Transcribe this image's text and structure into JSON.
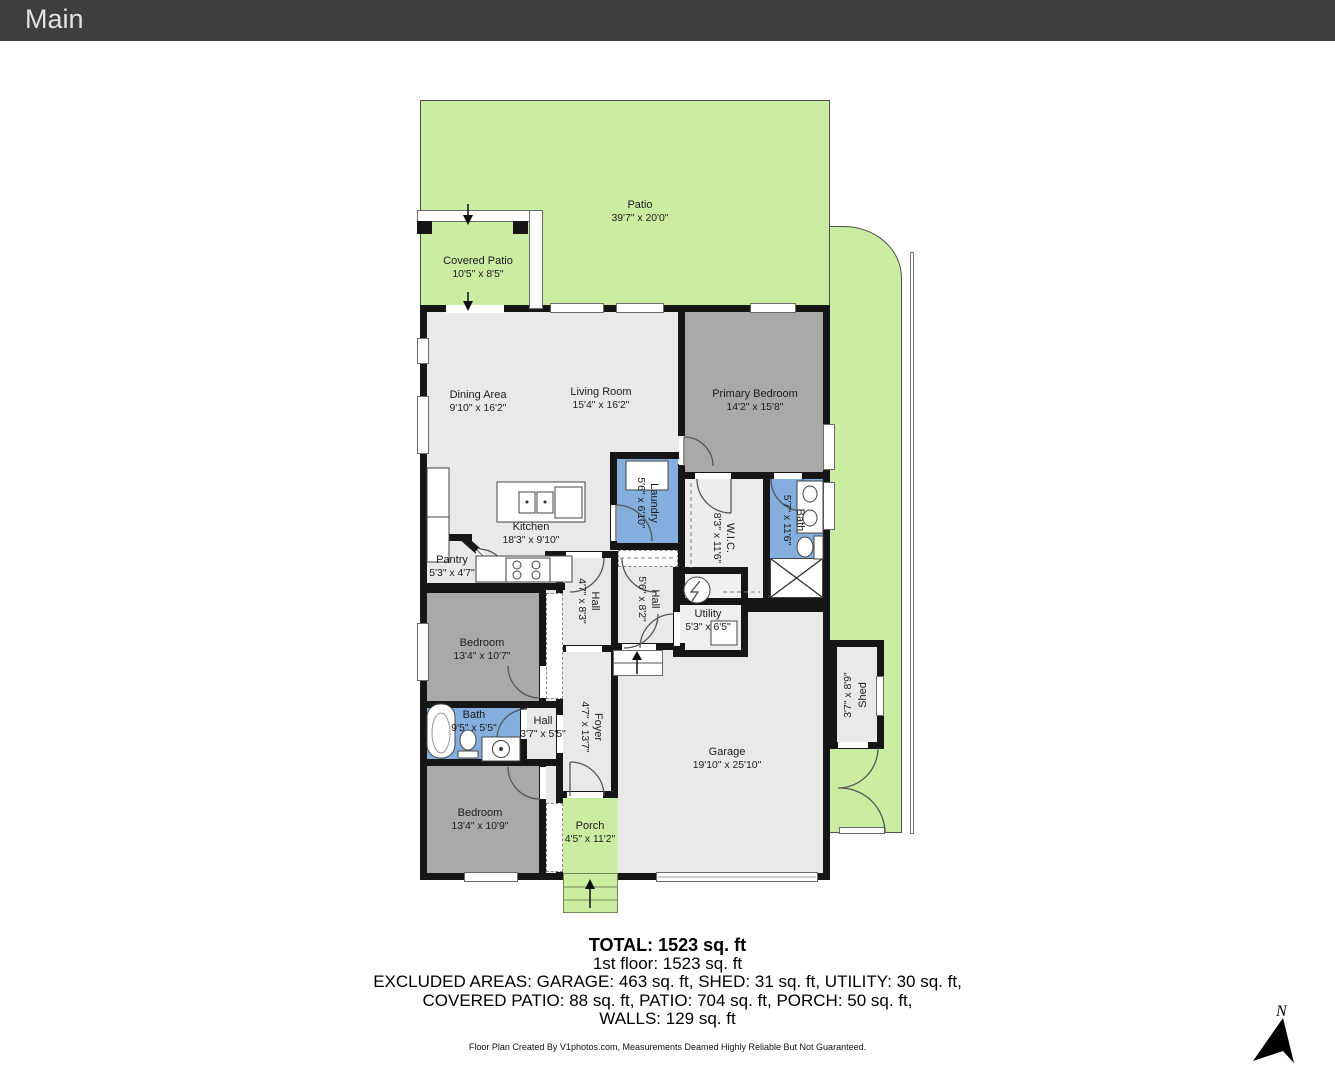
{
  "header": {
    "title": "Main"
  },
  "rooms": {
    "patio": {
      "name": "Patio",
      "dims": "39'7\" x 20'0\""
    },
    "covered_patio": {
      "name": "Covered Patio",
      "dims": "10'5\" x 8'5\""
    },
    "dining": {
      "name": "Dining Area",
      "dims": "9'10\" x 16'2\""
    },
    "living": {
      "name": "Living Room",
      "dims": "15'4\" x 16'2\""
    },
    "primary_bedroom": {
      "name": "Primary Bedroom",
      "dims": "14'2\" x 15'8\""
    },
    "kitchen": {
      "name": "Kitchen",
      "dims": "18'3\" x 9'10\""
    },
    "pantry": {
      "name": "Pantry",
      "dims": "5'3\" x 4'7\""
    },
    "laundry": {
      "name": "Laundry",
      "dims": "5'6\" x 6'10\""
    },
    "wic": {
      "name": "W.I.C.",
      "dims": "8'3\" x 11'6\""
    },
    "bath_primary": {
      "name": "Bath",
      "dims": "5'7\" x 11'6\""
    },
    "hall_upper": {
      "name": "Hall",
      "dims": "4'7\" x 8'3\""
    },
    "hall_center": {
      "name": "Hall",
      "dims": "5'6\" x 8'2\""
    },
    "utility": {
      "name": "Utility",
      "dims": "5'3\" x 6'5\""
    },
    "bedroom_mid": {
      "name": "Bedroom",
      "dims": "13'4\" x 10'7\""
    },
    "bath_hall": {
      "name": "Bath",
      "dims": "9'5\" x 5'5\""
    },
    "hall_small": {
      "name": "Hall",
      "dims": "3'7\" x 5'5\""
    },
    "foyer": {
      "name": "Foyer",
      "dims": "4'7\" x 13'7\""
    },
    "bedroom_lower": {
      "name": "Bedroom",
      "dims": "13'4\" x 10'9\""
    },
    "porch": {
      "name": "Porch",
      "dims": "4'5\" x 11'2\""
    },
    "garage": {
      "name": "Garage",
      "dims": "19'10\" x 25'10\""
    },
    "shed": {
      "name": "Shed",
      "dims": "3'7\" x 8'9\""
    }
  },
  "summary": {
    "total": "TOTAL: 1523 sq. ft",
    "first_floor": "1st floor: 1523 sq. ft",
    "excluded_line1": "EXCLUDED AREAS: GARAGE: 463 sq. ft, SHED: 31 sq. ft, UTILITY: 30 sq. ft,",
    "excluded_line2": "COVERED PATIO: 88 sq. ft, PATIO: 704 sq. ft, PORCH: 50 sq. ft,",
    "excluded_line3": "WALLS: 129 sq. ft",
    "disclaimer": "Floor Plan Created By V1photos.com, Measurements Deamed Highly Reliable But Not Guaranteed."
  },
  "compass": {
    "label": "N"
  },
  "colors": {
    "outdoor_green": "#cbeda1",
    "wall": "#161616",
    "floor_light": "#e9e9e9",
    "floor_gray": "#a9a9a9",
    "wet_blue": "#83aedd",
    "header_bg": "#3e3e3e"
  }
}
